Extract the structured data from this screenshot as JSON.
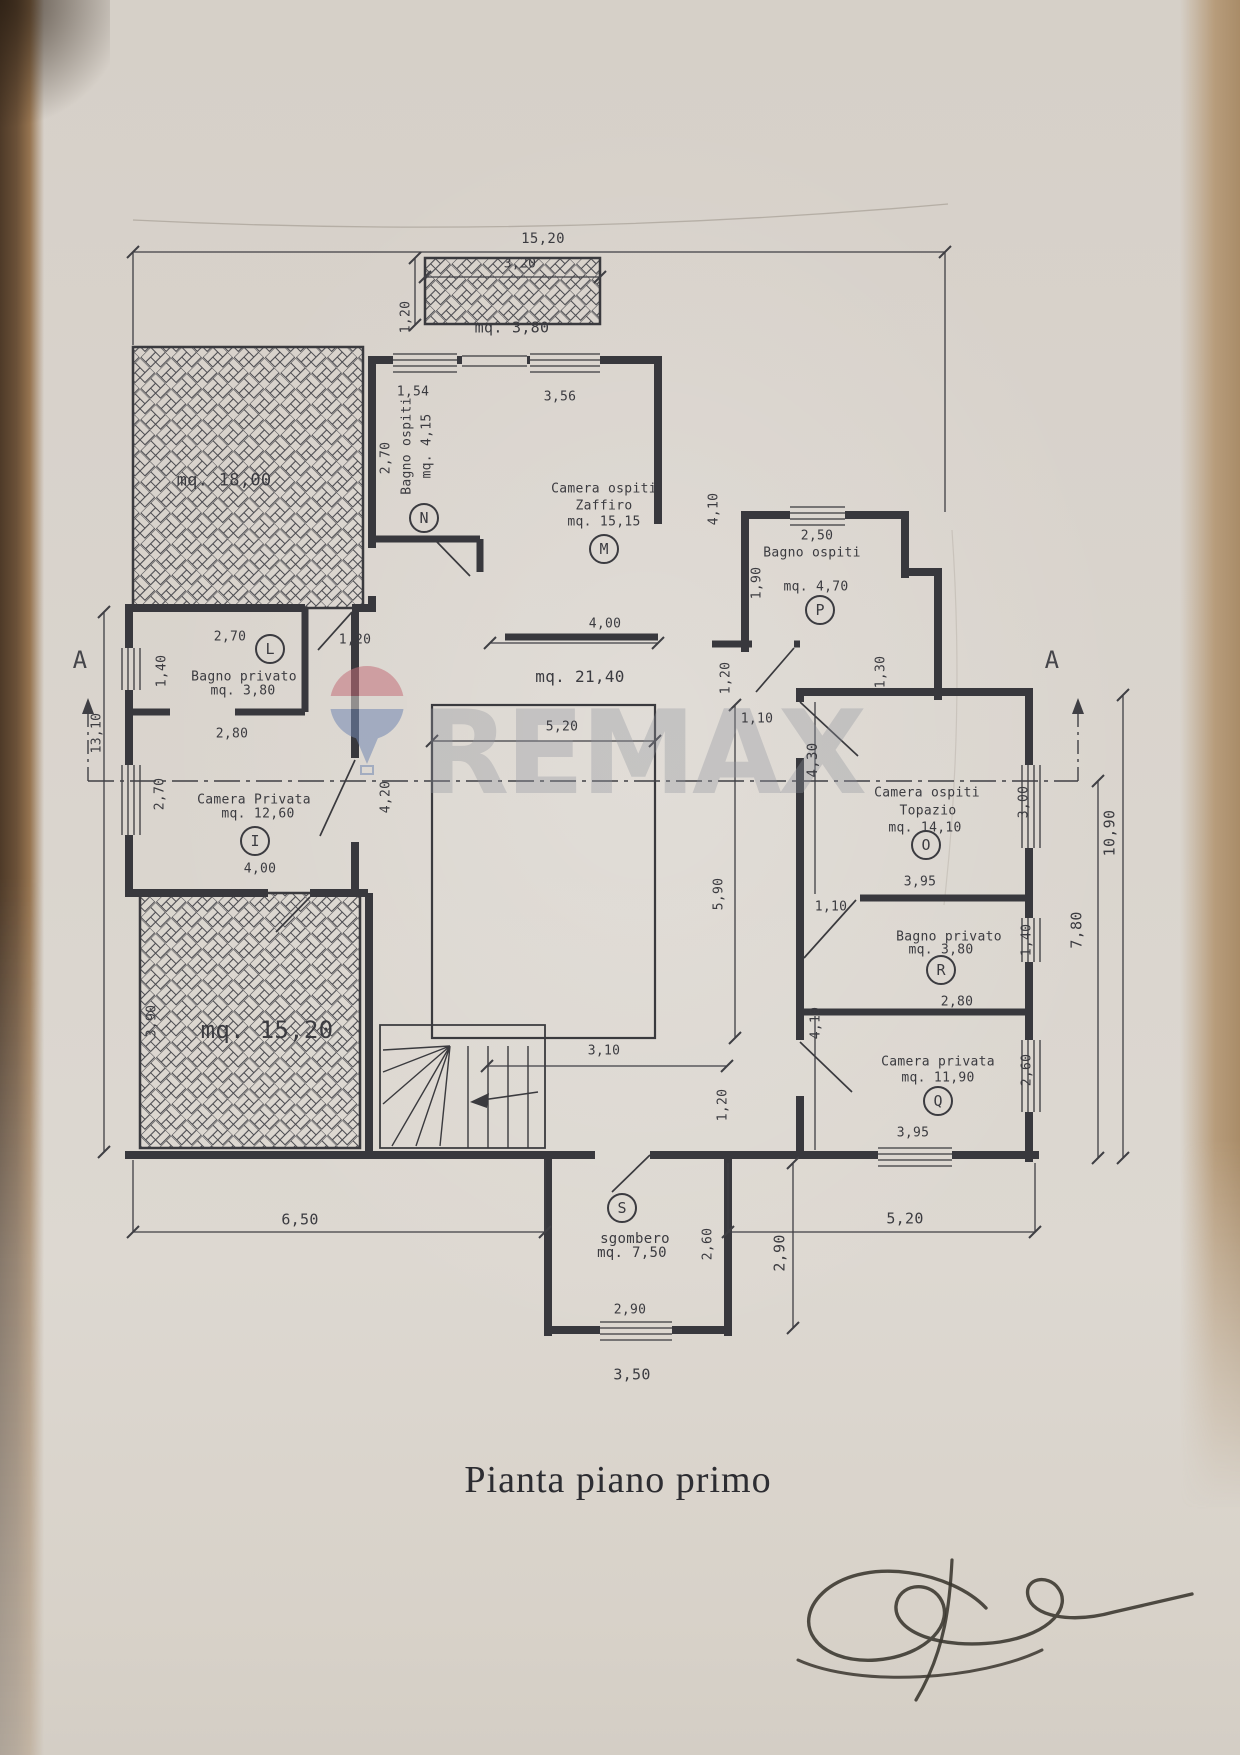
{
  "title": "Pianta piano primo",
  "watermark": {
    "brand": "REMAX",
    "balloon_red": "#c4707a",
    "balloon_blue": "#7388b3"
  },
  "colors": {
    "paper": "#d8d2cb",
    "ink": "#3b3b40",
    "table_edge_left": "#5e4730",
    "table_edge_right": "#b79c7b"
  },
  "section_markers": [
    {
      "label": "A",
      "x": 80,
      "y": 660
    },
    {
      "label": "A",
      "x": 1052,
      "y": 660
    }
  ],
  "area_labels": [
    {
      "text": "mq. 3,80",
      "x": 512,
      "y": 328,
      "size": 15,
      "name": "balcony-area"
    },
    {
      "text": "mq. 18,00",
      "x": 224,
      "y": 481,
      "size": 17,
      "name": "terrace-18-area"
    },
    {
      "text": "mq. 21,40",
      "x": 580,
      "y": 677,
      "size": 16,
      "name": "hall-area"
    },
    {
      "text": "mq. 15,20",
      "x": 267,
      "y": 1030,
      "size": 24,
      "name": "terrace-15-area"
    }
  ],
  "rooms": [
    {
      "id": "N",
      "room_name": "Bagno ospiti",
      "area": "mq. 4,15",
      "marker": {
        "x": 424,
        "y": 518
      },
      "lines": [
        {
          "text": "Bagno ospiti",
          "x": 407,
          "y": 446,
          "rot": -90
        },
        {
          "text": "mq. 4,15",
          "x": 427,
          "y": 446,
          "rot": -90
        }
      ]
    },
    {
      "id": "M",
      "room_name": "Camera ospiti Zaffiro",
      "area": "mq. 15,15",
      "marker": {
        "x": 604,
        "y": 549
      },
      "lines": [
        {
          "text": "Camera ospiti",
          "x": 604,
          "y": 489
        },
        {
          "text": "Zaffiro",
          "x": 604,
          "y": 506
        },
        {
          "text": "mq. 15,15",
          "x": 604,
          "y": 522
        }
      ]
    },
    {
      "id": "P",
      "room_name": "Bagno ospiti",
      "area": "mq. 4,70",
      "marker": {
        "x": 820,
        "y": 610
      },
      "lines": [
        {
          "text": "Bagno ospiti",
          "x": 812,
          "y": 553
        },
        {
          "text": "mq. 4,70",
          "x": 816,
          "y": 587
        }
      ]
    },
    {
      "id": "L",
      "room_name": "Bagno privato",
      "area": "mq. 3,80",
      "marker": {
        "x": 270,
        "y": 649
      },
      "lines": [
        {
          "text": "Bagno privato",
          "x": 244,
          "y": 677
        },
        {
          "text": "mq. 3,80",
          "x": 243,
          "y": 691
        }
      ]
    },
    {
      "id": "I",
      "room_name": "Camera Privata",
      "area": "mq. 12,60",
      "marker": {
        "x": 255,
        "y": 841
      },
      "lines": [
        {
          "text": "Camera Privata",
          "x": 254,
          "y": 800
        },
        {
          "text": "mq. 12,60",
          "x": 258,
          "y": 814
        }
      ]
    },
    {
      "id": "O",
      "room_name": "Camera ospiti Topazio",
      "area": "mq. 14,10",
      "marker": {
        "x": 926,
        "y": 845
      },
      "lines": [
        {
          "text": "Camera ospiti",
          "x": 927,
          "y": 793
        },
        {
          "text": "Topazio",
          "x": 928,
          "y": 811
        },
        {
          "text": "mq. 14,10",
          "x": 925,
          "y": 828
        }
      ]
    },
    {
      "id": "R",
      "room_name": "Bagno privato",
      "area": "mq. 3,80",
      "marker": {
        "x": 941,
        "y": 970
      },
      "lines": [
        {
          "text": "Bagno privato",
          "x": 949,
          "y": 937
        },
        {
          "text": "mq. 3,80",
          "x": 941,
          "y": 950
        }
      ]
    },
    {
      "id": "Q",
      "room_name": "Camera privata",
      "area": "mq. 11,90",
      "marker": {
        "x": 938,
        "y": 1101
      },
      "lines": [
        {
          "text": "Camera privata",
          "x": 938,
          "y": 1062
        },
        {
          "text": "mq. 11,90",
          "x": 938,
          "y": 1078
        }
      ]
    },
    {
      "id": "S",
      "room_name": "sgombero",
      "area": "mq. 7,50",
      "marker": {
        "x": 622,
        "y": 1208
      },
      "lines": [
        {
          "text": "sgombero",
          "x": 635,
          "y": 1239,
          "size": 14
        },
        {
          "text": "mq. 7,50",
          "x": 632,
          "y": 1253,
          "size": 14
        }
      ]
    }
  ],
  "dimensions": [
    {
      "text": "15,20",
      "x": 543,
      "y": 239,
      "size": 14
    },
    {
      "text": "3,20",
      "x": 520,
      "y": 264
    },
    {
      "text": "1,20",
      "x": 406,
      "y": 317,
      "rot": -90
    },
    {
      "text": "1,54",
      "x": 413,
      "y": 392
    },
    {
      "text": "3,56",
      "x": 560,
      "y": 397
    },
    {
      "text": "2,70",
      "x": 386,
      "y": 458,
      "rot": -90
    },
    {
      "text": "4,10",
      "x": 714,
      "y": 509,
      "rot": -90
    },
    {
      "text": "2,50",
      "x": 817,
      "y": 536
    },
    {
      "text": "1,90",
      "x": 757,
      "y": 583,
      "rot": -90
    },
    {
      "text": "1,30",
      "x": 881,
      "y": 672,
      "rot": -90
    },
    {
      "text": "1,20",
      "x": 726,
      "y": 678,
      "rot": -90
    },
    {
      "text": "4,00",
      "x": 605,
      "y": 624
    },
    {
      "text": "5,20",
      "x": 562,
      "y": 727
    },
    {
      "text": "1,10",
      "x": 757,
      "y": 719
    },
    {
      "text": "4,30",
      "x": 813,
      "y": 760,
      "rot": -90,
      "size": 14
    },
    {
      "text": "3,00",
      "x": 1024,
      "y": 802,
      "rot": -90
    },
    {
      "text": "3,95",
      "x": 920,
      "y": 882
    },
    {
      "text": "5,90",
      "x": 719,
      "y": 894,
      "rot": -90
    },
    {
      "text": "4,20",
      "x": 386,
      "y": 797,
      "rot": -90
    },
    {
      "text": "2,70",
      "x": 160,
      "y": 794,
      "rot": -90
    },
    {
      "text": "2,80",
      "x": 232,
      "y": 734
    },
    {
      "text": "2,70",
      "x": 230,
      "y": 637
    },
    {
      "text": "1,20",
      "x": 355,
      "y": 640
    },
    {
      "text": "1,40",
      "x": 162,
      "y": 671,
      "rot": -90
    },
    {
      "text": "4,00",
      "x": 260,
      "y": 869
    },
    {
      "text": "3,90",
      "x": 152,
      "y": 1021,
      "rot": -90
    },
    {
      "text": "13,10",
      "x": 97,
      "y": 733,
      "rot": -90
    },
    {
      "text": "1,10",
      "x": 831,
      "y": 907
    },
    {
      "text": "1,40",
      "x": 1027,
      "y": 940,
      "rot": -90
    },
    {
      "text": "2,80",
      "x": 957,
      "y": 1002
    },
    {
      "text": "4,10",
      "x": 816,
      "y": 1023,
      "rot": -90
    },
    {
      "text": "2,60",
      "x": 1027,
      "y": 1070,
      "rot": -90
    },
    {
      "text": "3,95",
      "x": 913,
      "y": 1133
    },
    {
      "text": "3,10",
      "x": 604,
      "y": 1051
    },
    {
      "text": "1,20",
      "x": 723,
      "y": 1105,
      "rot": -90
    },
    {
      "text": "2,60",
      "x": 708,
      "y": 1244,
      "rot": -90
    },
    {
      "text": "2,90",
      "x": 630,
      "y": 1310
    },
    {
      "text": "2,90",
      "x": 780,
      "y": 1253,
      "rot": -90,
      "size": 15
    },
    {
      "text": "3,50",
      "x": 632,
      "y": 1375,
      "size": 15
    },
    {
      "text": "6,50",
      "x": 300,
      "y": 1220,
      "size": 15
    },
    {
      "text": "5,20",
      "x": 905,
      "y": 1219,
      "size": 15
    },
    {
      "text": "10,90",
      "x": 1110,
      "y": 833,
      "rot": -90,
      "size": 15
    },
    {
      "text": "7,80",
      "x": 1077,
      "y": 930,
      "rot": -90,
      "size": 15
    }
  ]
}
